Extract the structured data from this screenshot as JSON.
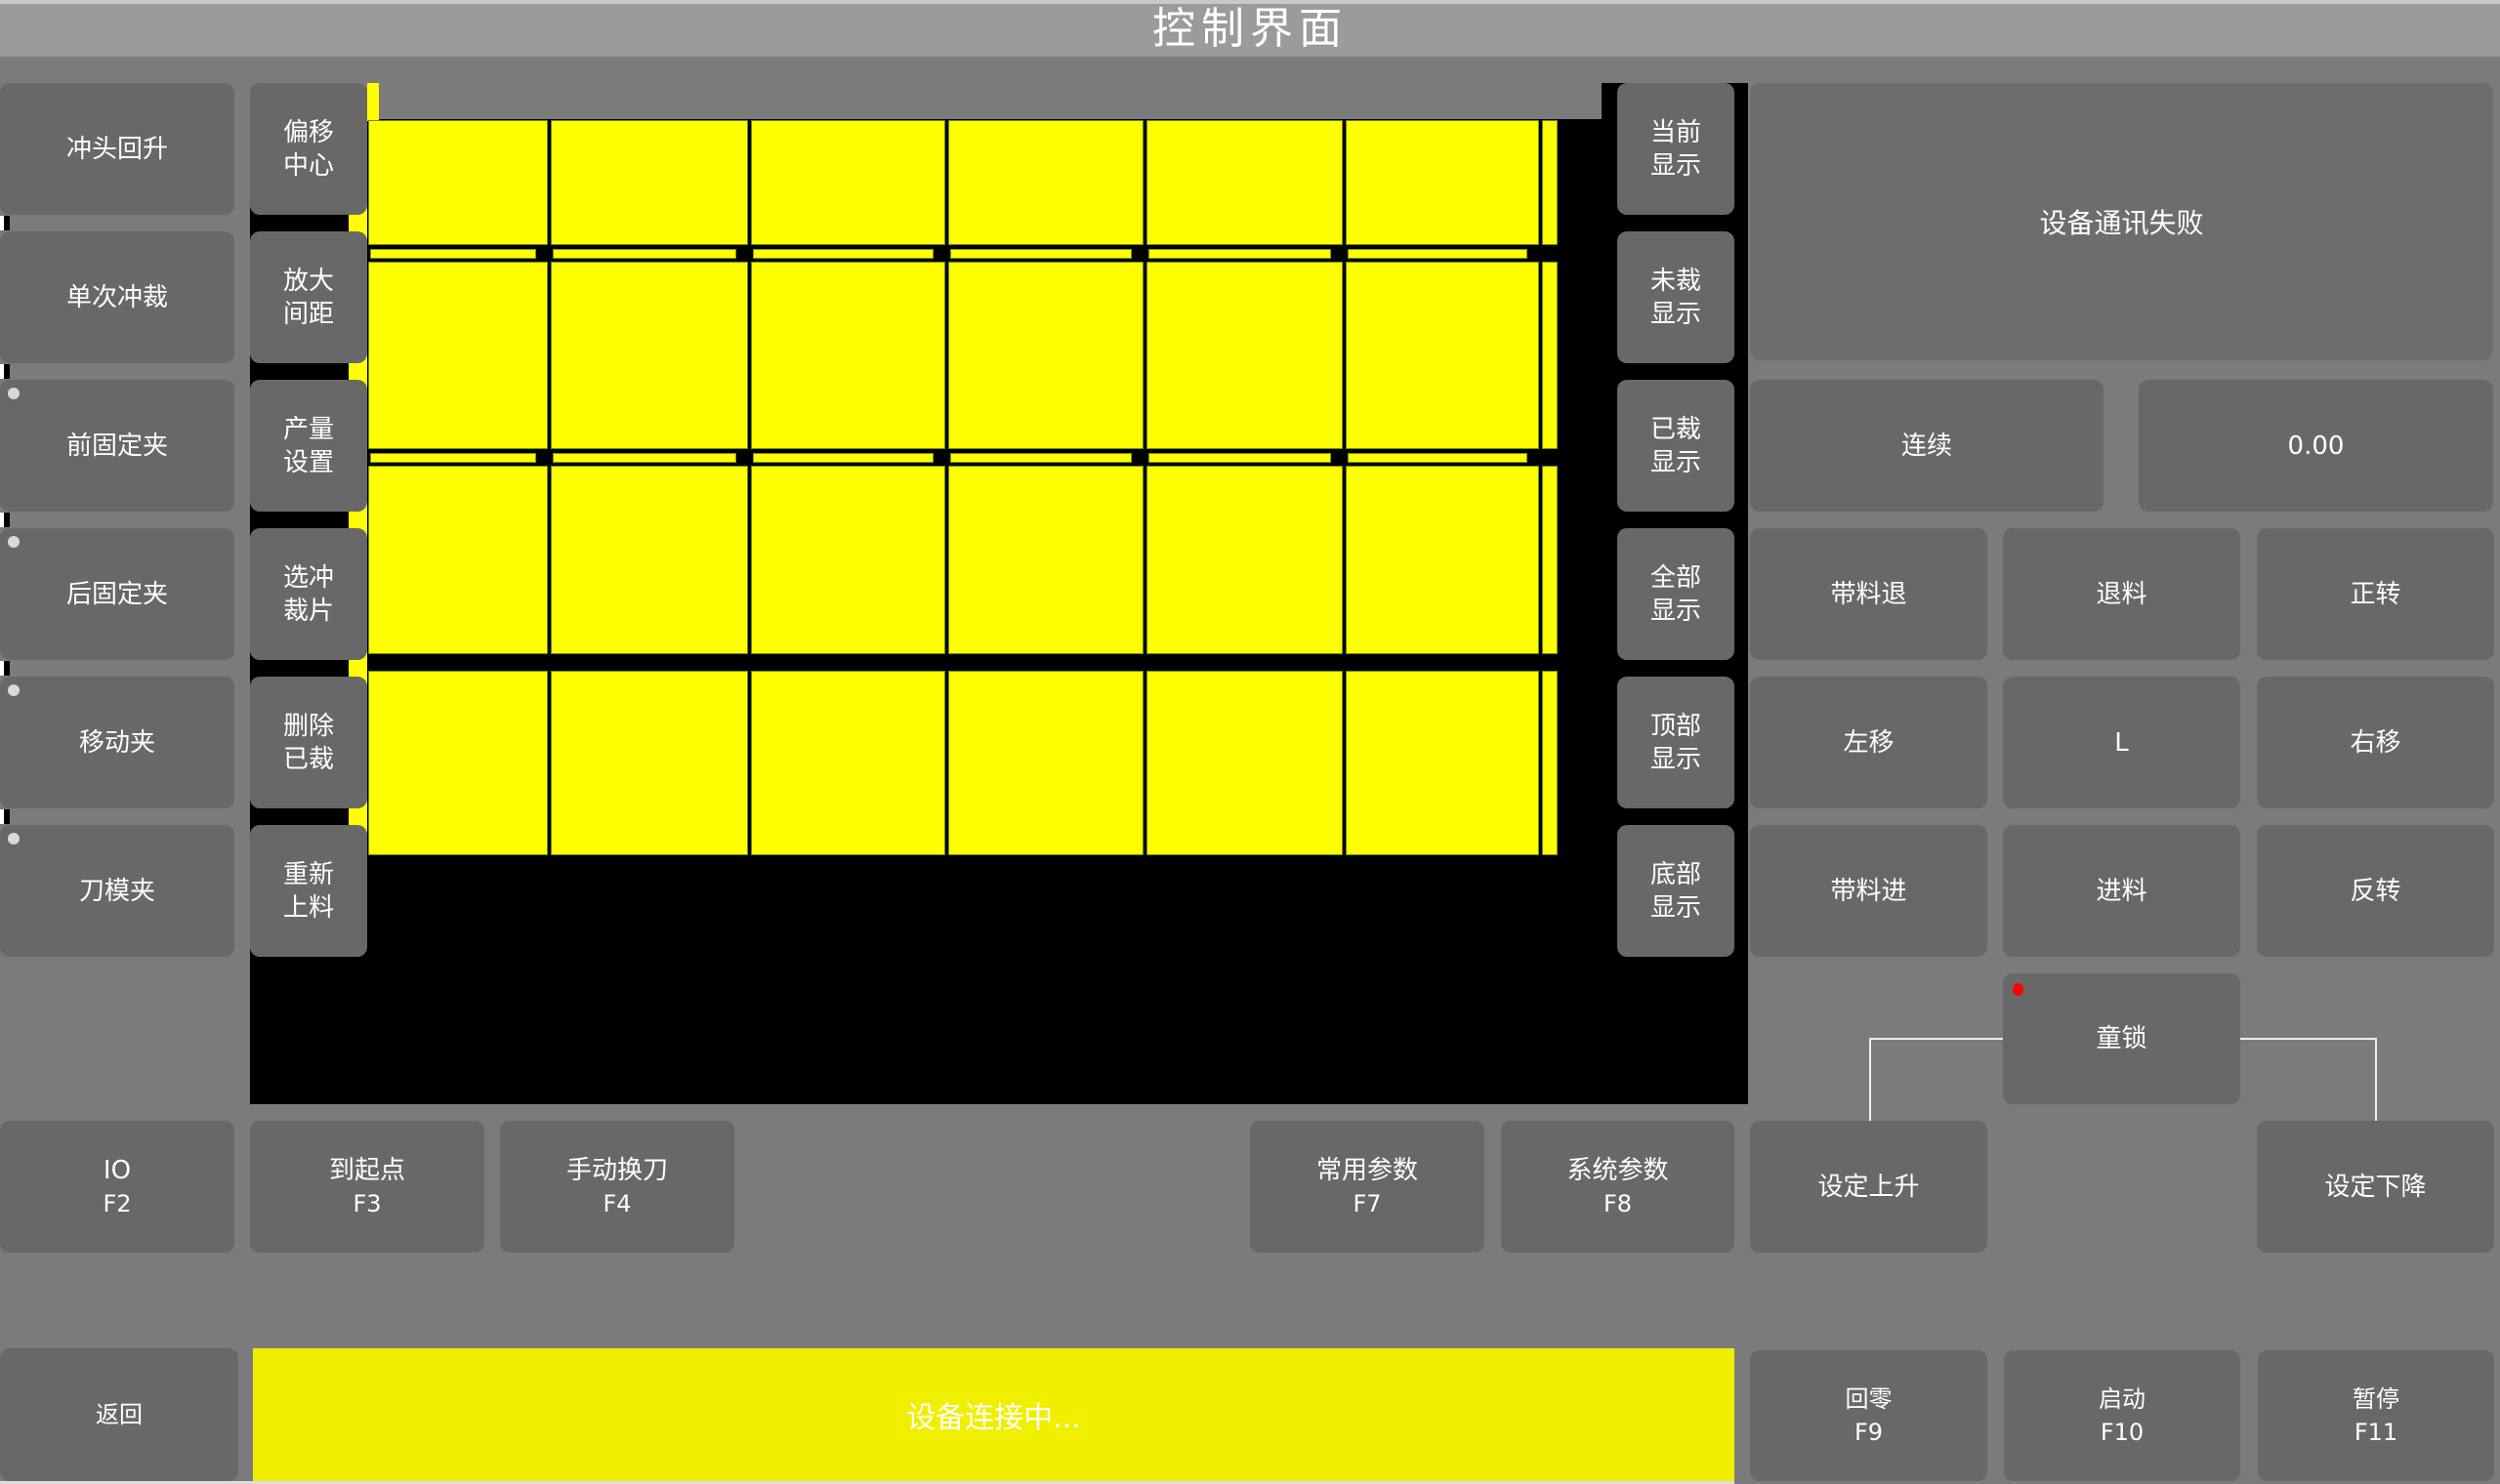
{
  "title": "控制界面",
  "left_column": {
    "items": [
      {
        "label": "冲头回升",
        "indicator": false
      },
      {
        "label": "单次冲裁",
        "indicator": false
      },
      {
        "label": "前固定夹",
        "indicator": true
      },
      {
        "label": "后固定夹",
        "indicator": true
      },
      {
        "label": "移动夹",
        "indicator": true
      },
      {
        "label": "刀模夹",
        "indicator": true
      }
    ]
  },
  "tool_column": {
    "items": [
      {
        "label": "偏移\n中心"
      },
      {
        "label": "放大\n间距"
      },
      {
        "label": "产量\n设置"
      },
      {
        "label": "选冲\n裁片"
      },
      {
        "label": "删除\n已裁"
      },
      {
        "label": "重新\n上料"
      }
    ]
  },
  "display_column": {
    "items": [
      {
        "label": "当前\n显示"
      },
      {
        "label": "未裁\n显示"
      },
      {
        "label": "已裁\n显示"
      },
      {
        "label": "全部\n显示"
      },
      {
        "label": "顶部\n显示"
      },
      {
        "label": "底部\n显示"
      }
    ]
  },
  "canvas": {
    "rows": 4,
    "columns": 6,
    "piece_color": "#ffff00",
    "background": "#000000"
  },
  "right_panel": {
    "message": "设备通讯失败",
    "mode_button": "连续",
    "value": "0.00",
    "jog_grid": [
      [
        "带料退",
        "退料",
        "正转"
      ],
      [
        "左移",
        "L",
        "右移"
      ],
      [
        "带料进",
        "进料",
        "反转"
      ]
    ],
    "child_lock": "童锁",
    "set_rise": "设定上升",
    "set_fall": "设定下降"
  },
  "function_row": [
    {
      "label": "IO",
      "fkey": "F2"
    },
    {
      "label": "到起点",
      "fkey": "F3"
    },
    {
      "label": "手动换刀",
      "fkey": "F4"
    },
    {
      "label": "常用参数",
      "fkey": "F7"
    },
    {
      "label": "系统参数",
      "fkey": "F8"
    }
  ],
  "bottom_bar": {
    "back": "返回",
    "status": "设备连接中...",
    "home": {
      "label": "回零",
      "fkey": "F9"
    },
    "start": {
      "label": "启动",
      "fkey": "F10"
    },
    "pause": {
      "label": "暂停",
      "fkey": "F11"
    }
  },
  "colors": {
    "accent_yellow": "#ffff00",
    "status_yellow": "#f0ef00",
    "button_gray": "#686868",
    "alarm_red": "#ff0000",
    "indicator_gray": "#d9d9d9"
  }
}
